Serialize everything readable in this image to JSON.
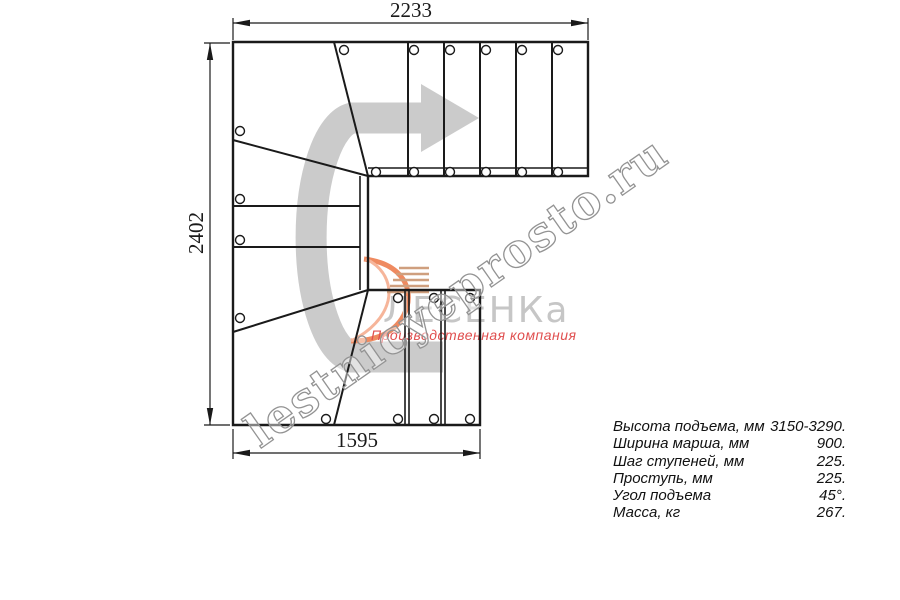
{
  "drawing": {
    "title_hint": "stair-plan-top-view",
    "dimensions": {
      "top": "2233",
      "left": "2402",
      "bottom": "1595"
    },
    "direction_arrow_icon": "u-turn-arrow-right",
    "colors": {
      "line": "#1a1a1a",
      "arrow_gray": "#cbcbcb",
      "logo_gray": "#c6c6c6",
      "logo_orange": "#ef8a60",
      "tagline_red": "#e04f4f",
      "watermark_gray": "#939393"
    }
  },
  "logo": {
    "name": "ЛЕСЕНКа",
    "tagline": "Производственная компания",
    "swoosh_icon": "orange-swoosh"
  },
  "watermark": {
    "text": "lestnicyeprosto.ru"
  },
  "specs": {
    "rows": [
      {
        "label": "Высота подъема, мм",
        "value": "3150-3290."
      },
      {
        "label": "Ширина марша, мм",
        "value": "900."
      },
      {
        "label": "Шаг ступеней, мм",
        "value": "225."
      },
      {
        "label": "Проступь, мм",
        "value": "225."
      },
      {
        "label": "Угол подъема",
        "value": "45°."
      },
      {
        "label": "Масса, кг",
        "value": "267."
      }
    ]
  }
}
